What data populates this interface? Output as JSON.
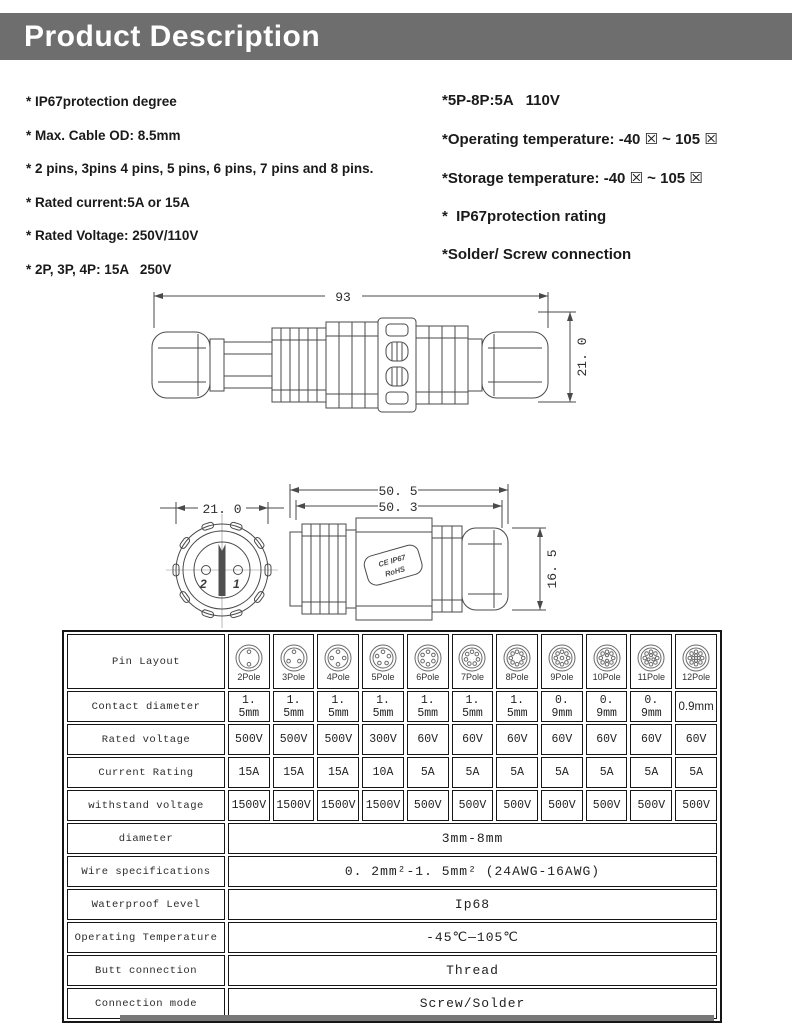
{
  "colors": {
    "banner_bg": "#6e6e6e",
    "drawing_line": "#4a4a4a",
    "table_border": "#161616"
  },
  "banner": {
    "title": "Product Description"
  },
  "specs_left": [
    "* IP67protection degree",
    "* Max. Cable OD: 8.5mm",
    "* 2 pins, 3pins 4 pins, 5 pins, 6 pins, 7 pins and 8 pins.",
    "* Rated current:5A or 15A",
    "* Rated Voltage: 250V/110V",
    "* 2P, 3P, 4P: 15A   250V"
  ],
  "specs_right": [
    "*5P-8P:5A   110V",
    "*Operating temperature: -40 ☒ ~ 105 ☒",
    "*Storage temperature: -40 ☒ ~ 105 ☒",
    "*  IP67protection rating",
    "*Solder/ Screw connection"
  ],
  "drawing1": {
    "length_label": "93",
    "height_label": "21. 0"
  },
  "drawing2": {
    "front_width_label": "21. 0",
    "pin_left": "2",
    "pin_right": "1",
    "outer_length_label": "50. 5",
    "inner_length_label": "50. 3",
    "height_label": "16. 5",
    "plate_line1": "CE IP67",
    "plate_line2": "RoHS"
  },
  "table": {
    "rows": [
      {
        "kind": "poles",
        "label": "Pin Layout",
        "cells": [
          {
            "n": 2,
            "label": "2Pole"
          },
          {
            "n": 3,
            "label": "3Pole"
          },
          {
            "n": 4,
            "label": "4Pole"
          },
          {
            "n": 5,
            "label": "5Pole"
          },
          {
            "n": 6,
            "label": "6Pole"
          },
          {
            "n": 7,
            "label": "7Pole"
          },
          {
            "n": 8,
            "label": "8Pole"
          },
          {
            "n": 9,
            "label": "9Pole"
          },
          {
            "n": 10,
            "label": "10Pole"
          },
          {
            "n": 11,
            "label": "11Pole"
          },
          {
            "n": 12,
            "label": "12Pole"
          }
        ]
      },
      {
        "kind": "cells",
        "label": "Contact diameter",
        "sans_last": true,
        "cells": [
          "1. 5mm",
          "1. 5mm",
          "1. 5mm",
          "1. 5mm",
          "1. 5mm",
          "1. 5mm",
          "1. 5mm",
          "0. 9mm",
          "0. 9mm",
          "0. 9mm",
          "0.9mm"
        ]
      },
      {
        "kind": "cells",
        "label": "Rated voltage",
        "cells": [
          "500V",
          "500V",
          "500V",
          "300V",
          "60V",
          "60V",
          "60V",
          "60V",
          "60V",
          "60V",
          "60V"
        ]
      },
      {
        "kind": "cells",
        "label": "Current Rating",
        "cells": [
          "15A",
          "15A",
          "15A",
          "10A",
          "5A",
          "5A",
          "5A",
          "5A",
          "5A",
          "5A",
          "5A"
        ]
      },
      {
        "kind": "cells",
        "label": "withstand voltage",
        "cells": [
          "1500V",
          "1500V",
          "1500V",
          "1500V",
          "500V",
          "500V",
          "500V",
          "500V",
          "500V",
          "500V",
          "500V"
        ]
      },
      {
        "kind": "span",
        "label": "diameter",
        "value": "3mm-8mm"
      },
      {
        "kind": "span",
        "label": "Wire specifications",
        "value": "0. 2mm²-1. 5mm² (24AWG-16AWG)"
      },
      {
        "kind": "span",
        "label": "Waterproof Level",
        "value": "Ip68"
      },
      {
        "kind": "span",
        "label": "Operating Temperature",
        "value": "-45℃—105℃"
      },
      {
        "kind": "span",
        "label": "Butt connection",
        "value": "Thread"
      },
      {
        "kind": "span",
        "label": "Connection mode",
        "value": "Screw/Solder"
      }
    ]
  }
}
